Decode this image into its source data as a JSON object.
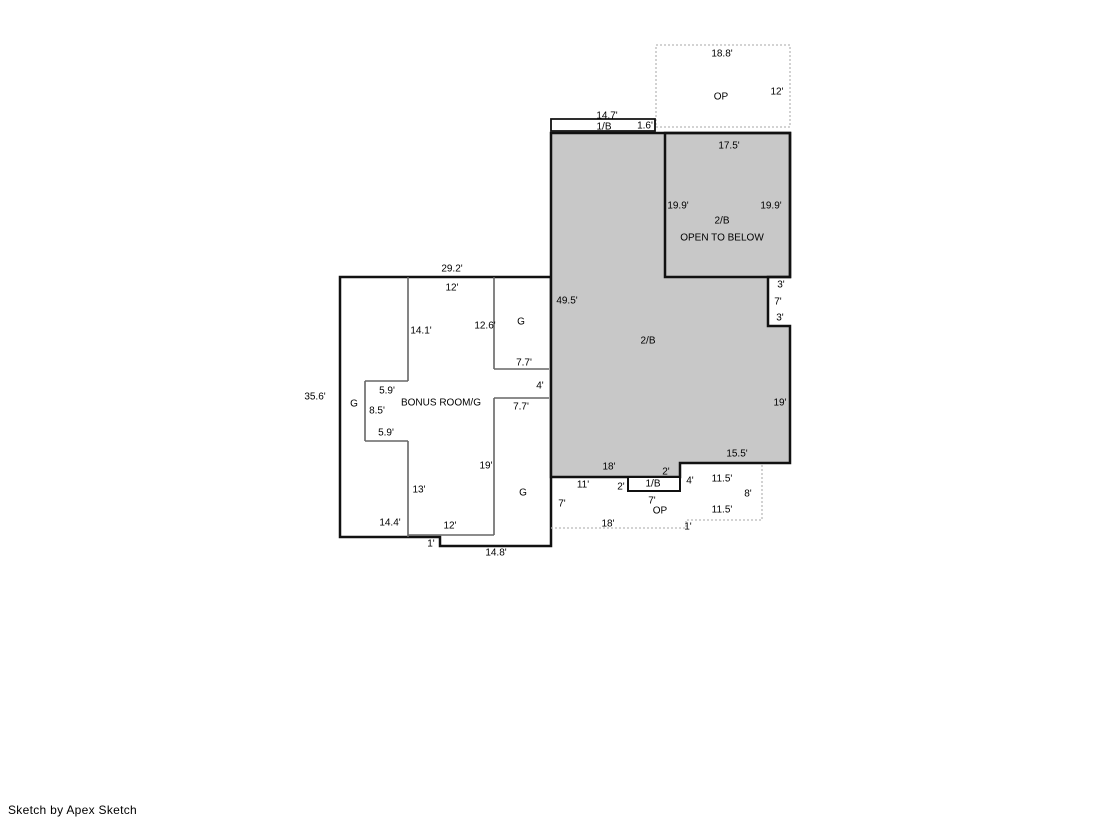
{
  "page": {
    "footer": "Sketch by Apex Sketch",
    "background": "#ffffff"
  },
  "colors": {
    "wall": "#111111",
    "interior_line": "#666666",
    "dashed_line": "#b9b9b9",
    "shaded_fill": "#c8c8c8",
    "open_fill": "#ffffff",
    "text": "#000000"
  },
  "floorplan": {
    "units": "feet",
    "shapes": [
      {
        "name": "area-op-upper",
        "kind": "polygon",
        "pts": [
          656,
          45,
          790,
          45,
          790,
          127,
          656,
          127
        ],
        "fill": "#ffffff",
        "stroke": "#b9b9b9",
        "w": 1.3,
        "dash": "2 2"
      },
      {
        "name": "structure-bonus-room-garage",
        "kind": "polygon",
        "pts": [
          340,
          277,
          551,
          277,
          551,
          546,
          440,
          546,
          440,
          537,
          340,
          537
        ],
        "fill": "#ffffff",
        "stroke": "#111111",
        "w": 2.5
      },
      {
        "name": "interior-wall",
        "kind": "line",
        "pts": [
          408,
          277,
          408,
          381
        ],
        "stroke": "#666666",
        "w": 1.6
      },
      {
        "name": "interior-wall",
        "kind": "line",
        "pts": [
          365,
          381,
          408,
          381
        ],
        "stroke": "#666666",
        "w": 1.6
      },
      {
        "name": "interior-wall",
        "kind": "line",
        "pts": [
          365,
          381,
          365,
          441
        ],
        "stroke": "#666666",
        "w": 1.6
      },
      {
        "name": "interior-wall",
        "kind": "line",
        "pts": [
          365,
          441,
          408,
          441
        ],
        "stroke": "#666666",
        "w": 1.6
      },
      {
        "name": "interior-wall",
        "kind": "line",
        "pts": [
          408,
          441,
          408,
          537
        ],
        "stroke": "#666666",
        "w": 1.6
      },
      {
        "name": "interior-wall",
        "kind": "line",
        "pts": [
          408,
          535,
          494,
          535
        ],
        "stroke": "#666666",
        "w": 1.6
      },
      {
        "name": "interior-wall",
        "kind": "line",
        "pts": [
          494,
          277,
          494,
          369
        ],
        "stroke": "#666666",
        "w": 1.6
      },
      {
        "name": "interior-wall",
        "kind": "line",
        "pts": [
          494,
          369,
          549,
          369
        ],
        "stroke": "#666666",
        "w": 1.6
      },
      {
        "name": "interior-wall",
        "kind": "line",
        "pts": [
          494,
          398,
          549,
          398
        ],
        "stroke": "#666666",
        "w": 1.6
      },
      {
        "name": "interior-wall",
        "kind": "line",
        "pts": [
          494,
          398,
          494,
          535
        ],
        "stroke": "#666666",
        "w": 1.6
      },
      {
        "name": "area-2b-main",
        "kind": "polygon",
        "pts": [
          551,
          133,
          790,
          133,
          790,
          277,
          768,
          277,
          768,
          326,
          790,
          326,
          790,
          463,
          680,
          463,
          680,
          477,
          551,
          477
        ],
        "fill": "#c8c8c8",
        "stroke": "#111111",
        "w": 2.5
      },
      {
        "name": "area-open-to-below",
        "kind": "polygon",
        "pts": [
          665,
          133,
          790,
          133,
          790,
          277,
          665,
          277
        ],
        "fill": "none",
        "stroke": "#111111",
        "w": 2.5
      },
      {
        "name": "area-1b-top-strip",
        "kind": "polygon",
        "pts": [
          551,
          119,
          655,
          119,
          655,
          131,
          551,
          131
        ],
        "fill": "#ffffff",
        "stroke": "#111111",
        "w": 1.8
      },
      {
        "name": "area-1b-bottom-box",
        "kind": "polygon",
        "pts": [
          628,
          477,
          680,
          477,
          680,
          491,
          628,
          491
        ],
        "fill": "#ffffff",
        "stroke": "#111111",
        "w": 2
      },
      {
        "name": "area-op-lower",
        "kind": "polyline",
        "pts": [
          551,
          528,
          686,
          528,
          686,
          520,
          762,
          520,
          762,
          463
        ],
        "fill": "none",
        "stroke": "#b9b9b9",
        "w": 1.3,
        "dash": "2 2"
      }
    ],
    "labels": [
      {
        "t": "18.8'",
        "x": 722,
        "y": 53
      },
      {
        "t": "OP",
        "x": 721,
        "y": 96,
        "n": "room-label-op-upper"
      },
      {
        "t": "12'",
        "x": 777,
        "y": 91
      },
      {
        "t": "14.7'",
        "x": 607,
        "y": 115
      },
      {
        "t": "1/B",
        "x": 604,
        "y": 126,
        "n": "room-label-1b-top"
      },
      {
        "t": "1.6'",
        "x": 645,
        "y": 125
      },
      {
        "t": "17.5'",
        "x": 729,
        "y": 145
      },
      {
        "t": "19.9'",
        "x": 678,
        "y": 205
      },
      {
        "t": "19.9'",
        "x": 771,
        "y": 205
      },
      {
        "t": "2/B",
        "x": 722,
        "y": 220,
        "n": "room-label-2b-open-below"
      },
      {
        "t": "OPEN TO BELOW",
        "x": 722,
        "y": 237,
        "n": "room-label-open-to-below"
      },
      {
        "t": "49.5'",
        "x": 567,
        "y": 300
      },
      {
        "t": "2/B",
        "x": 648,
        "y": 340,
        "n": "room-label-2b-main"
      },
      {
        "t": "3'",
        "x": 781,
        "y": 284
      },
      {
        "t": "7'",
        "x": 778,
        "y": 301
      },
      {
        "t": "3'",
        "x": 780,
        "y": 317
      },
      {
        "t": "19'",
        "x": 780,
        "y": 402
      },
      {
        "t": "15.5'",
        "x": 737,
        "y": 453
      },
      {
        "t": "18'",
        "x": 609,
        "y": 466
      },
      {
        "t": "2'",
        "x": 666,
        "y": 471
      },
      {
        "t": "11'",
        "x": 583,
        "y": 484
      },
      {
        "t": "2'",
        "x": 621,
        "y": 486
      },
      {
        "t": "1/B",
        "x": 653,
        "y": 483,
        "n": "room-label-1b-bottom"
      },
      {
        "t": "4'",
        "x": 690,
        "y": 480
      },
      {
        "t": "7'",
        "x": 652,
        "y": 500
      },
      {
        "t": "7'",
        "x": 562,
        "y": 503
      },
      {
        "t": "OP",
        "x": 660,
        "y": 510,
        "n": "room-label-op-lower"
      },
      {
        "t": "18'",
        "x": 608,
        "y": 523
      },
      {
        "t": "1'",
        "x": 688,
        "y": 526
      },
      {
        "t": "11.5'",
        "x": 722,
        "y": 478
      },
      {
        "t": "8'",
        "x": 748,
        "y": 493
      },
      {
        "t": "11.5'",
        "x": 722,
        "y": 509
      },
      {
        "t": "29.2'",
        "x": 452,
        "y": 268
      },
      {
        "t": "12'",
        "x": 452,
        "y": 287
      },
      {
        "t": "14.1'",
        "x": 421,
        "y": 330
      },
      {
        "t": "12.6'",
        "x": 485,
        "y": 325
      },
      {
        "t": "G",
        "x": 521,
        "y": 321,
        "n": "room-label-g-upper"
      },
      {
        "t": "7.7'",
        "x": 524,
        "y": 362
      },
      {
        "t": "35.6'",
        "x": 315,
        "y": 396
      },
      {
        "t": "G",
        "x": 354,
        "y": 403,
        "n": "room-label-g-corridor"
      },
      {
        "t": "5.9'",
        "x": 387,
        "y": 390
      },
      {
        "t": "8.5'",
        "x": 377,
        "y": 410
      },
      {
        "t": "5.9'",
        "x": 386,
        "y": 432
      },
      {
        "t": "BONUS ROOM/G",
        "x": 441,
        "y": 402,
        "n": "room-label-bonus-room"
      },
      {
        "t": "4'",
        "x": 540,
        "y": 385
      },
      {
        "t": "7.7'",
        "x": 521,
        "y": 406
      },
      {
        "t": "19'",
        "x": 486,
        "y": 465
      },
      {
        "t": "13'",
        "x": 419,
        "y": 489
      },
      {
        "t": "G",
        "x": 523,
        "y": 492,
        "n": "room-label-g-lower"
      },
      {
        "t": "14.4'",
        "x": 390,
        "y": 522
      },
      {
        "t": "12'",
        "x": 450,
        "y": 525
      },
      {
        "t": "1'",
        "x": 431,
        "y": 543
      },
      {
        "t": "14.8'",
        "x": 496,
        "y": 552
      }
    ]
  }
}
